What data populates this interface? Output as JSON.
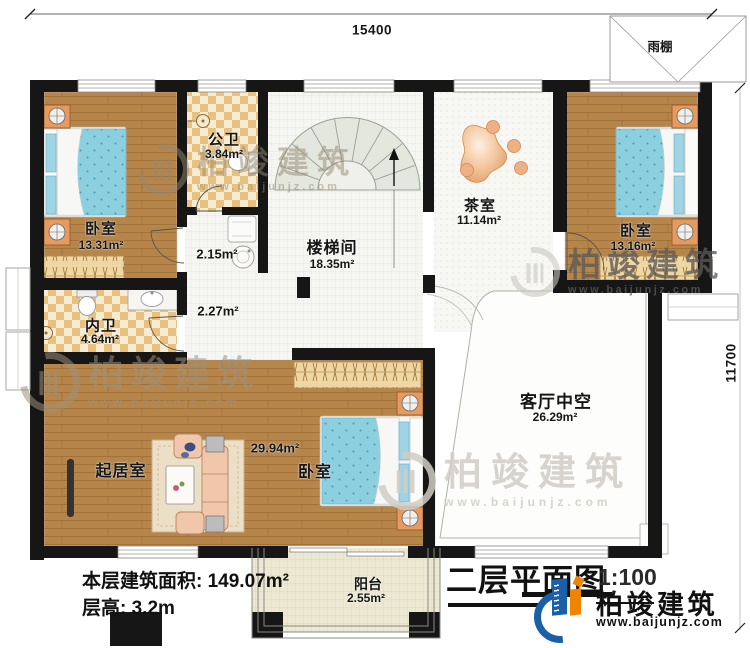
{
  "page": {
    "title": "二层平面图",
    "scale": "1:100"
  },
  "dimensions": {
    "top": "15400",
    "right": "11700"
  },
  "canopy_label": "雨棚",
  "rooms": {
    "bedroom_tl": {
      "name": "卧室",
      "area": "13.31m²"
    },
    "public_bath": {
      "name": "公卫",
      "area": "3.84m²"
    },
    "lavatory": {
      "area": "2.15m²"
    },
    "hallway": {
      "area": "2.27m²"
    },
    "stairwell": {
      "name": "楼梯间",
      "area": "18.35m²"
    },
    "tea_room": {
      "name": "茶室",
      "area": "11.14m²"
    },
    "bedroom_tr": {
      "name": "卧室",
      "area": "13.16m²"
    },
    "inner_bath": {
      "name": "内卫",
      "area": "4.64m²"
    },
    "living_room": {
      "name": "起居室"
    },
    "bedroom_bm": {
      "name": "卧室",
      "area": "29.94m²"
    },
    "void": {
      "name": "客厅中空",
      "area": "26.29m²"
    },
    "balcony": {
      "name": "阳台",
      "area": "2.55m²"
    }
  },
  "footer": {
    "floor_area_label": "本层建筑面积:",
    "floor_area_value": "149.07m²",
    "floor_height_label": "层高:",
    "floor_height_value": "3.2m"
  },
  "brand": {
    "name": "柏竣建筑",
    "url": "www.baijunjz.com"
  },
  "watermark": {
    "name": "柏竣建筑",
    "url": "www.baijunjz.com"
  },
  "colors": {
    "wall": "#161616",
    "wood": "#b5854a",
    "tile_a": "#f7ecd2",
    "tile_b": "#e9c17f",
    "bed": "#8ccfdf",
    "logo_blue": "#1b5fa9",
    "logo_orange": "#f08300"
  }
}
